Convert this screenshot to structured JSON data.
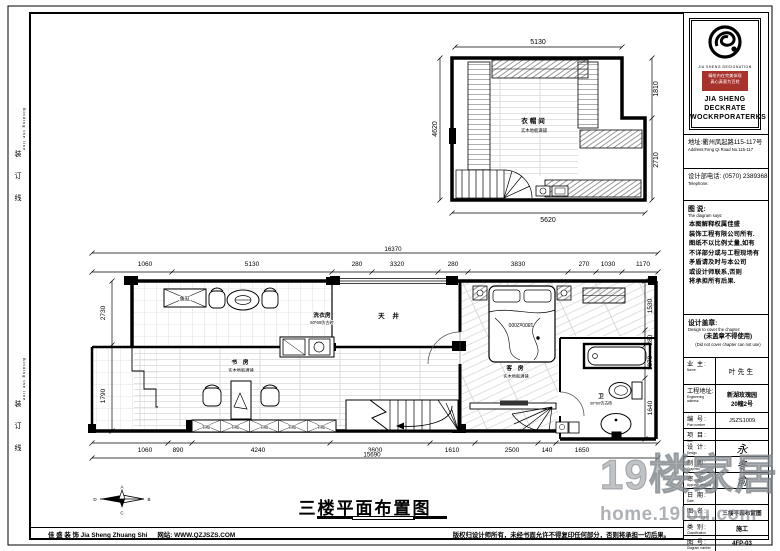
{
  "binding": {
    "cn": "装 订 线",
    "en": "Binding the line"
  },
  "upper_plan": {
    "room": "衣帽间",
    "floor": "实木地板满铺",
    "dims": {
      "top": "5130",
      "left": "4620",
      "right_top": "1810",
      "right_bottom": "2710",
      "bottom": "5620"
    }
  },
  "main_plan": {
    "totals": {
      "top": "16370",
      "bottom": "15690"
    },
    "top": [
      "1060",
      "5130",
      "280",
      "3320",
      "280",
      "3830",
      "270",
      "1030",
      "1170"
    ],
    "bottom": [
      "1060",
      "890",
      "4240",
      "3600",
      "1610",
      "2500",
      "140",
      "1650"
    ],
    "left": [
      "2730",
      "1790"
    ],
    "right": [
      "1530",
      "280",
      "1070",
      "1640"
    ],
    "rooms": {
      "laundry": {
        "name": "洗衣房",
        "floor": "60*60仿古砖"
      },
      "lightwell": {
        "name": "天 井"
      },
      "study": {
        "name": "书 房",
        "floor": "实木地板满铺"
      },
      "guest": {
        "name": "客 房",
        "floor": "实木地板满铺"
      },
      "bath": {
        "name": "卫",
        "floor": "30*60仿古砖"
      }
    },
    "labels": {
      "fish_tank": "鱼缸",
      "bed_size": "1800x2000",
      "bookcase": "书柜"
    }
  },
  "drawing_title": "三楼平面布置图",
  "compass": {
    "top": "A",
    "right": "B",
    "bottom": "C",
    "left": "D"
  },
  "title_block": {
    "logo_sub": "JIA SHENG DESIGNATION",
    "slogan1": "精绘内在完美体现",
    "slogan2": "真心真意为百姓",
    "company1": "JIA SHENG DECKRATE",
    "company2": "WOCKRPORATERKS",
    "address_cn": "地址:衢州凤起路115-117号",
    "address_en": "Address:Feng Qi Road No.115-117",
    "phone_cn": "设计部电话: (0570) 2389368",
    "phone_en": "Telephone:",
    "notes_title_cn": "图 说:",
    "notes_title_en": "The diagram says:",
    "notes_lines": [
      "本图解释权属佳盛",
      "装饰工程有限公司所有.",
      "图纸不以比例丈量,如有",
      "不详部分或与工程现场有",
      "矛盾请及时与本公司",
      "或设计师联系,否则",
      "将承担所有后果."
    ],
    "seal_title_cn": "设计盖章:",
    "seal_title_en": "Design to cover the chapter:",
    "seal_note_cn": "(未盖章不得使用)",
    "seal_note_en": "(Did not cover chapter can not use)",
    "owner_label": "业 主:",
    "owner_label_en": "Name:",
    "owner_value": "叶先生",
    "site_label": "工程地址:",
    "site_label_en": "Engineering address:",
    "site_value1": "新湖玫瑰园",
    "site_value2": "20幢2号",
    "rows": [
      {
        "label": "编 号:",
        "en": "Plan number",
        "value": "JSZS1009"
      },
      {
        "label": "项 目:",
        "en": "Item",
        "value": ""
      },
      {
        "label": "设 计:",
        "en": "Design",
        "value": "永"
      },
      {
        "label": "制 图:",
        "en": "Graphics",
        "value": "冬"
      },
      {
        "label": "审 定:",
        "en": "Approve officially",
        "value": "俞"
      },
      {
        "label": "日 期:",
        "en": "Date",
        "value": ""
      },
      {
        "label": "图 名:",
        "en": "Name for figure",
        "value": "三楼平面布置图"
      },
      {
        "label": "类 别:",
        "en": "Classification",
        "value": "施工"
      },
      {
        "label": "图 号:",
        "en": "Diagram number",
        "value": "4FP-03"
      }
    ]
  },
  "footer": {
    "company": "佳 盛 装 饰  Jia Sheng Zhuang Shi",
    "website": "网站: WWW.QZJSZS.COM",
    "copyright": "版权归设计师所有，未经书面允许不得复印任何部分，否则将承担一切后果。"
  },
  "watermark": {
    "brand": "19楼家居",
    "url": "home.19lou.com"
  }
}
